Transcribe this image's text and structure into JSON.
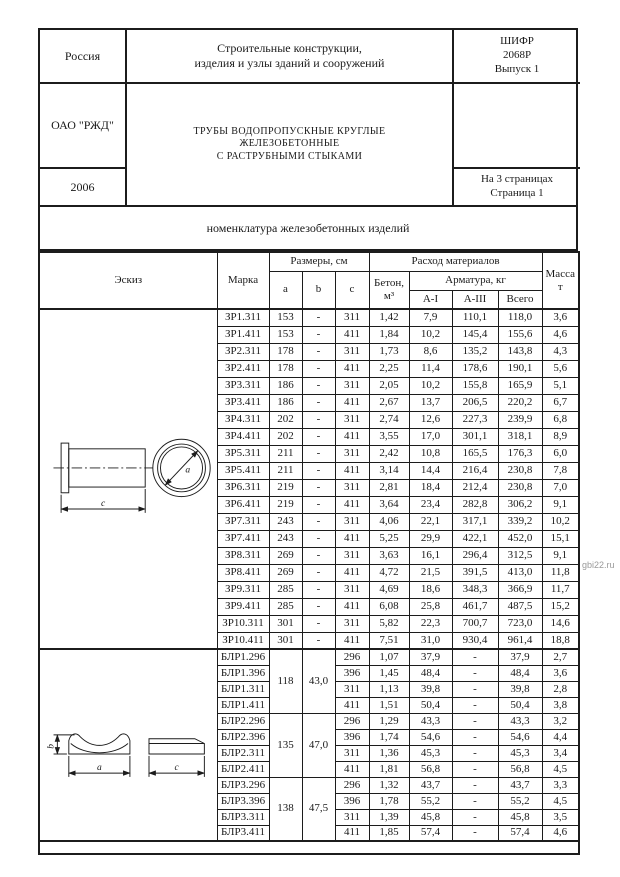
{
  "page": {
    "header": {
      "country": "Россия",
      "classification_line1": "Строительные конструкции,",
      "classification_line2": "изделия и узлы зданий и сооружений",
      "cipher_line1": "ШИФР",
      "cipher_line2": "2068Р",
      "cipher_line3": "Выпуск 1",
      "organization": "ОАО \"РЖД\"",
      "product_title_line1": "ТРУБЫ ВОДОПРОПУСКНЫЕ КРУГЛЫЕ",
      "product_title_line2": "ЖЕЛЕЗОБЕТОННЫЕ",
      "product_title_line3": "С РАСТРУБНЫМИ СТЫКАМИ",
      "year": "2006",
      "pages_line1": "На 3 страницах",
      "pages_line2": "Страница 1"
    },
    "section_title": "номенклатура железобетонных изделий",
    "table": {
      "headers": {
        "sketch": "Эскиз",
        "mark": "Марка",
        "dimensions": "Размеры, см",
        "dim_a": "a",
        "dim_b": "b",
        "dim_c": "c",
        "materials": "Расход материалов",
        "concrete_line1": "Бетон,",
        "concrete_line2": "м³",
        "rebar": "Арматура, кг",
        "rebar_ai": "А-I",
        "rebar_aiii": "А-III",
        "rebar_total": "Всего",
        "mass_line1": "Масса",
        "mass_line2": "т"
      },
      "groups": [
        {
          "id": "zr",
          "sketch": "pipe-with-socket",
          "rows": [
            {
              "mark": "ЗР1.311",
              "a": "153",
              "b": "-",
              "c": "311",
              "concrete": "1,42",
              "ai": "7,9",
              "aiii": "110,1",
              "total": "118,0",
              "mass": "3,6"
            },
            {
              "mark": "ЗР1.411",
              "a": "153",
              "b": "-",
              "c": "411",
              "concrete": "1,84",
              "ai": "10,2",
              "aiii": "145,4",
              "total": "155,6",
              "mass": "4,6"
            },
            {
              "mark": "ЗР2.311",
              "a": "178",
              "b": "-",
              "c": "311",
              "concrete": "1,73",
              "ai": "8,6",
              "aiii": "135,2",
              "total": "143,8",
              "mass": "4,3"
            },
            {
              "mark": "ЗР2.411",
              "a": "178",
              "b": "-",
              "c": "411",
              "concrete": "2,25",
              "ai": "11,4",
              "aiii": "178,6",
              "total": "190,1",
              "mass": "5,6"
            },
            {
              "mark": "ЗР3.311",
              "a": "186",
              "b": "-",
              "c": "311",
              "concrete": "2,05",
              "ai": "10,2",
              "aiii": "155,8",
              "total": "165,9",
              "mass": "5,1"
            },
            {
              "mark": "ЗР3.411",
              "a": "186",
              "b": "-",
              "c": "411",
              "concrete": "2,67",
              "ai": "13,7",
              "aiii": "206,5",
              "total": "220,2",
              "mass": "6,7"
            },
            {
              "mark": "ЗР4.311",
              "a": "202",
              "b": "-",
              "c": "311",
              "concrete": "2,74",
              "ai": "12,6",
              "aiii": "227,3",
              "total": "239,9",
              "mass": "6,8"
            },
            {
              "mark": "ЗР4.411",
              "a": "202",
              "b": "-",
              "c": "411",
              "concrete": "3,55",
              "ai": "17,0",
              "aiii": "301,1",
              "total": "318,1",
              "mass": "8,9"
            },
            {
              "mark": "ЗР5.311",
              "a": "211",
              "b": "-",
              "c": "311",
              "concrete": "2,42",
              "ai": "10,8",
              "aiii": "165,5",
              "total": "176,3",
              "mass": "6,0"
            },
            {
              "mark": "ЗР5.411",
              "a": "211",
              "b": "-",
              "c": "411",
              "concrete": "3,14",
              "ai": "14,4",
              "aiii": "216,4",
              "total": "230,8",
              "mass": "7,8"
            },
            {
              "mark": "ЗР6.311",
              "a": "219",
              "b": "-",
              "c": "311",
              "concrete": "2,81",
              "ai": "18,4",
              "aiii": "212,4",
              "total": "230,8",
              "mass": "7,0"
            },
            {
              "mark": "ЗР6.411",
              "a": "219",
              "b": "-",
              "c": "411",
              "concrete": "3,64",
              "ai": "23,4",
              "aiii": "282,8",
              "total": "306,2",
              "mass": "9,1"
            },
            {
              "mark": "ЗР7.311",
              "a": "243",
              "b": "-",
              "c": "311",
              "concrete": "4,06",
              "ai": "22,1",
              "aiii": "317,1",
              "total": "339,2",
              "mass": "10,2"
            },
            {
              "mark": "ЗР7.411",
              "a": "243",
              "b": "-",
              "c": "411",
              "concrete": "5,25",
              "ai": "29,9",
              "aiii": "422,1",
              "total": "452,0",
              "mass": "15,1"
            },
            {
              "mark": "ЗР8.311",
              "a": "269",
              "b": "-",
              "c": "311",
              "concrete": "3,63",
              "ai": "16,1",
              "aiii": "296,4",
              "total": "312,5",
              "mass": "9,1"
            },
            {
              "mark": "ЗР8.411",
              "a": "269",
              "b": "-",
              "c": "411",
              "concrete": "4,72",
              "ai": "21,5",
              "aiii": "391,5",
              "total": "413,0",
              "mass": "11,8"
            },
            {
              "mark": "ЗР9.311",
              "a": "285",
              "b": "-",
              "c": "311",
              "concrete": "4,69",
              "ai": "18,6",
              "aiii": "348,3",
              "total": "366,9",
              "mass": "11,7"
            },
            {
              "mark": "ЗР9.411",
              "a": "285",
              "b": "-",
              "c": "411",
              "concrete": "6,08",
              "ai": "25,8",
              "aiii": "461,7",
              "total": "487,5",
              "mass": "15,2"
            },
            {
              "mark": "ЗР10.311",
              "a": "301",
              "b": "-",
              "c": "311",
              "concrete": "5,82",
              "ai": "22,3",
              "aiii": "700,7",
              "total": "723,0",
              "mass": "14,6"
            },
            {
              "mark": "ЗР10.411",
              "a": "301",
              "b": "-",
              "c": "411",
              "concrete": "7,51",
              "ai": "31,0",
              "aiii": "930,4",
              "total": "961,4",
              "mass": "18,8"
            }
          ]
        },
        {
          "id": "blr",
          "sketch": "saddle-block",
          "subgroups": [
            {
              "a": "118",
              "b": "43,0",
              "rows": [
                {
                  "mark": "БЛР1.296",
                  "c": "296",
                  "concrete": "1,07",
                  "ai": "37,9",
                  "aiii": "-",
                  "total": "37,9",
                  "mass": "2,7"
                },
                {
                  "mark": "БЛР1.396",
                  "c": "396",
                  "concrete": "1,45",
                  "ai": "48,4",
                  "aiii": "-",
                  "total": "48,4",
                  "mass": "3,6"
                },
                {
                  "mark": "БЛР1.311",
                  "c": "311",
                  "concrete": "1,13",
                  "ai": "39,8",
                  "aiii": "-",
                  "total": "39,8",
                  "mass": "2,8"
                },
                {
                  "mark": "БЛР1.411",
                  "c": "411",
                  "concrete": "1,51",
                  "ai": "50,4",
                  "aiii": "-",
                  "total": "50,4",
                  "mass": "3,8"
                }
              ]
            },
            {
              "a": "135",
              "b": "47,0",
              "rows": [
                {
                  "mark": "БЛР2.296",
                  "c": "296",
                  "concrete": "1,29",
                  "ai": "43,3",
                  "aiii": "-",
                  "total": "43,3",
                  "mass": "3,2"
                },
                {
                  "mark": "БЛР2.396",
                  "c": "396",
                  "concrete": "1,74",
                  "ai": "54,6",
                  "aiii": "-",
                  "total": "54,6",
                  "mass": "4,4"
                },
                {
                  "mark": "БЛР2.311",
                  "c": "311",
                  "concrete": "1,36",
                  "ai": "45,3",
                  "aiii": "-",
                  "total": "45,3",
                  "mass": "3,4"
                },
                {
                  "mark": "БЛР2.411",
                  "c": "411",
                  "concrete": "1,81",
                  "ai": "56,8",
                  "aiii": "-",
                  "total": "56,8",
                  "mass": "4,5"
                }
              ]
            },
            {
              "a": "138",
              "b": "47,5",
              "rows": [
                {
                  "mark": "БЛР3.296",
                  "c": "296",
                  "concrete": "1,32",
                  "ai": "43,7",
                  "aiii": "-",
                  "total": "43,7",
                  "mass": "3,3"
                },
                {
                  "mark": "БЛР3.396",
                  "c": "396",
                  "concrete": "1,78",
                  "ai": "55,2",
                  "aiii": "-",
                  "total": "55,2",
                  "mass": "4,5"
                },
                {
                  "mark": "БЛР3.311",
                  "c": "311",
                  "concrete": "1,39",
                  "ai": "45,8",
                  "aiii": "-",
                  "total": "45,8",
                  "mass": "3,5"
                },
                {
                  "mark": "БЛР3.411",
                  "c": "411",
                  "concrete": "1,85",
                  "ai": "57,4",
                  "aiii": "-",
                  "total": "57,4",
                  "mass": "4,6"
                }
              ]
            }
          ]
        }
      ]
    },
    "sketches": {
      "pipe": {
        "diameter_label": "a",
        "length_label": "c"
      },
      "saddle": {
        "width_label": "a",
        "height_label": "b",
        "length_label": "c"
      }
    },
    "watermark": "gbi22.ru"
  }
}
